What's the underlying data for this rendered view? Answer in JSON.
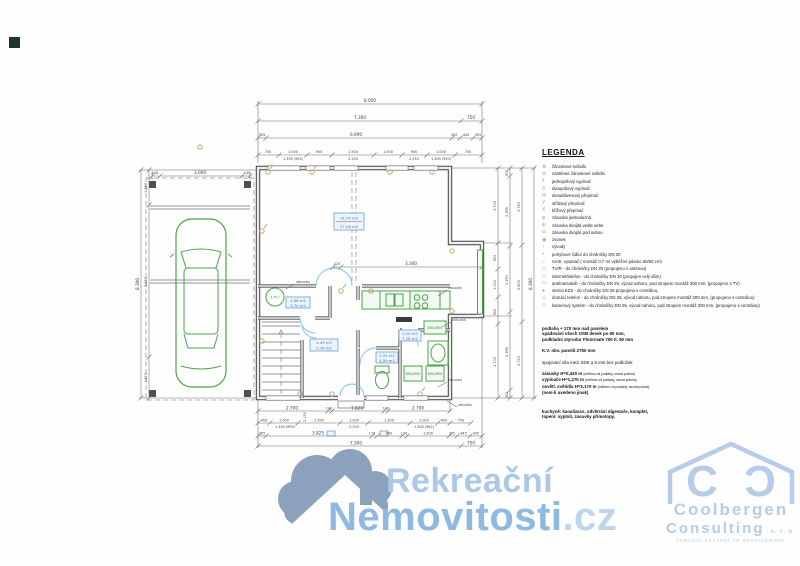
{
  "legend": {
    "title": "LEGENDA",
    "items": [
      {
        "sym": "⊗",
        "label": "žárovkové svítidlo"
      },
      {
        "sym": "⊘",
        "label": "nástěnné žárovkové svítidlo"
      },
      {
        "sym": "λ",
        "label": "jednopólový vypínač"
      },
      {
        "sym": "Λ",
        "label": "dvoupólový vypínač"
      },
      {
        "sym": "Ψ",
        "label": "dvouklávesový přepínač"
      },
      {
        "sym": "Υ",
        "label": "střídavý přepínač"
      },
      {
        "sym": "Χ",
        "label": "křížový přepínač"
      },
      {
        "sym": "φ",
        "label": "zásuvka jednoduchá"
      },
      {
        "sym": "ψ",
        "label": "zásuvka dvojitá vedle sebe"
      },
      {
        "sym": "ω",
        "label": "zásuvka dvojitá pod sebou"
      },
      {
        "sym": "◉",
        "label": "zvonek"
      },
      {
        "sym": "↑",
        "label": "vývody"
      },
      {
        "sym": "◐",
        "label": "pohybové čidlo/ do chráničky DN 20"
      },
      {
        "sym": "○",
        "label": "centr. vysavač ( montáž 0,7 m/ výběžné pásmo 60/60 cm)"
      },
      {
        "sym": "◇",
        "label": "TV/R - do chráničky DN 20 (propojeno s anténou)"
      },
      {
        "sym": "◇",
        "label": "internet/telefon - do chráničky DN 20 (propojen celý dům)"
      },
      {
        "sym": "◇",
        "label": "anténa/satelit - do chráničky DN 25, vývod nahoru, pod stropem montáž 300 mm, (propojeno s TV)"
      },
      {
        "sym": "●",
        "label": "siréna EZS - do chráničky DN 26 propojena s centrálou,"
      },
      {
        "sym": "◇",
        "label": "domácí telefon - do chráničky DN 25, vývod nahoru, pod stropem montáž 300 mm, (propojeno s centrálou)"
      },
      {
        "sym": "◇",
        "label": "kamerový systém - do chráničky DN 25, vývod nahoru, pod stropem montáž 300 mm, (propojeno s centrálou)"
      }
    ]
  },
  "notes": {
    "block1": [
      "podlaha + 170 mm nad panelem",
      "spádování všech OSB desek po 60 mm,",
      "podkladní styrodur Floormate 700 tl. 50 mm"
    ],
    "block2": [
      "K.V. obv. panelů 2750 mm"
    ],
    "block3": [
      "spojovací síta mezi SDK a 8 mm bez podložek"
    ],
    "block4": [
      {
        "b": "zásuvky H=0,420 m",
        "n": "(měřeno od podlahy, osová poloha)"
      },
      {
        "b": "vypínače H=1,270 m",
        "n": "(měřeno od podlahy, osová poloha)"
      },
      {
        "b": "osvětl. světidla H=2,170 m",
        "n": "(měřeno od podlahy, osová poloha)"
      },
      {
        "b": "(není-li uvedeno jinak)",
        "n": ""
      }
    ],
    "block5": [
      "kuchyně: kanalizace, odvětrání digestoře, komplet,",
      "topení: vyplnit, zásuvky přímotopy."
    ]
  },
  "plan": {
    "rooms": {
      "living": [
        "14,74 m2",
        "27,26 m2"
      ],
      "tech": [
        "1,96 m2",
        "3,70 m2"
      ],
      "hall": [
        "4,43 m2",
        "5,76 m2"
      ],
      "wc": [
        "1,31 m2",
        "4,59 m2"
      ],
      "bath": [
        "3,10 m2",
        "7,26 m2"
      ]
    },
    "fixtures": {
      "boiler": "175 l",
      "kitchen_unit": "800/600",
      "washer": "600/600",
      "dryer": "600/600"
    },
    "callout": "zásuvka",
    "dims": {
      "top": {
        "total": "8.050",
        "row2": [
          "7.300",
          "750"
        ],
        "row3": [
          "305",
          "6.690",
          "305",
          "445",
          "305"
        ],
        "row4": [
          "750",
          "1.000",
          "900",
          "1.500",
          "1.000",
          "900",
          "1.000",
          "750"
        ],
        "row4sub": [
          "1.300 (950)",
          "2.250",
          "2.250",
          "1.300 (950)"
        ],
        "carport": [
          "140",
          "3.000",
          "140"
        ]
      },
      "bottom": {
        "row1": [
          "2.700",
          "140",
          "1.820",
          "140",
          "2.700"
        ],
        "row2": [
          "450",
          "1.000",
          "1.500",
          "1.000",
          "1.500",
          "1.000",
          "450",
          "750"
        ],
        "row2sub": [
          "1.300 (950)",
          "2.250",
          "1.300 (962)"
        ],
        "row3": [
          "305",
          "3.825",
          "170",
          "900",
          "170",
          "1.500",
          "305",
          "445",
          "305"
        ],
        "row4": [
          "7.300",
          "750"
        ]
      },
      "left": {
        "total": "8.300",
        "inner": [
          "1.250",
          "5.480",
          "1.570"
        ]
      },
      "right": {
        "col1": [
          "2.700",
          "950",
          "1.000",
          "950",
          "2.700"
        ],
        "col2": [
          "305",
          "2.395",
          "2.290",
          "2.395",
          "305"
        ],
        "col3": [
          "2.750",
          "2.800",
          "2.750"
        ],
        "total": "8.300"
      },
      "inner": [
        "220",
        "3.300"
      ],
      "stair": "2.150"
    }
  },
  "watermark": {
    "word1": "Rekreační",
    "word2": "Nemovitosti",
    "suffix": ".cz"
  },
  "consulting_logo": {
    "monogram_left": "C",
    "monogram_right": "Ɔ",
    "name": "Coolbergen",
    "name2": "Consulting",
    "legal": "s. r. o.",
    "tagline": "lowcost concept re development"
  }
}
